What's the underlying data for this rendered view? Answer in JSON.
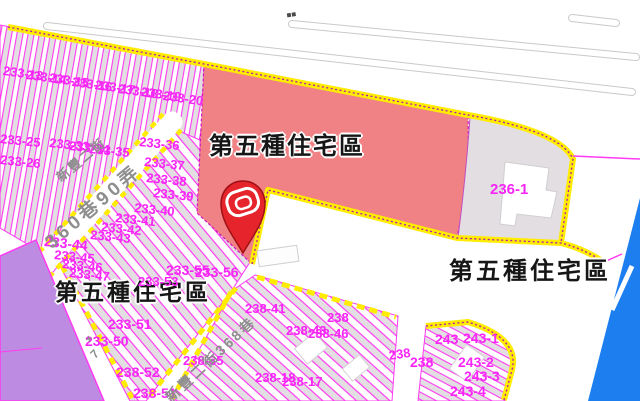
{
  "map": {
    "colors": {
      "red_zone": "#f08184",
      "road_yellow": "#ffec00",
      "boundary_magenta": "#ff3af2",
      "boundary_dark": "#b517ae",
      "parcel_text_magenta": "#f726f7",
      "purple_zone": "#bd8ce2",
      "blue_zone": "#1d7ef0",
      "parcel_gray": "#e2dee2",
      "pin_red": "#e6242b",
      "pin_dark": "#9e1116",
      "road_casing_gray": "#c9c9c9",
      "road_text_gray": "#8e8e8e",
      "zone_label_ink": "#161616"
    },
    "zone_labels": [
      {
        "text": "第五種住宅區",
        "x": 209,
        "y": 135,
        "size": 24,
        "ls": 2
      },
      {
        "text": "第五種住宅區",
        "x": 55,
        "y": 281,
        "size": 23,
        "ls": 3
      },
      {
        "text": "第五種住宅區",
        "x": 449,
        "y": 260,
        "size": 24,
        "ls": 3
      }
    ],
    "parcel_labels": [
      {
        "text": "233-13",
        "x": 4,
        "y": 64,
        "rot": 8
      },
      {
        "text": "233-14",
        "x": 27,
        "y": 68,
        "rot": 8
      },
      {
        "text": "233-15",
        "x": 50,
        "y": 71,
        "rot": 8
      },
      {
        "text": "233-16",
        "x": 73,
        "y": 75,
        "rot": 8
      },
      {
        "text": "233-17",
        "x": 96,
        "y": 78,
        "rot": 8
      },
      {
        "text": "233-18",
        "x": 119,
        "y": 82,
        "rot": 8
      },
      {
        "text": "233-19",
        "x": 142,
        "y": 85,
        "rot": 8
      },
      {
        "text": "233-20",
        "x": 164,
        "y": 89,
        "rot": 8
      },
      {
        "text": "233-25",
        "x": 1,
        "y": 132,
        "rot": 6
      },
      {
        "text": "233-33",
        "x": 50,
        "y": 136,
        "rot": 6
      },
      {
        "text": "233-34",
        "x": 70,
        "y": 139,
        "rot": 6
      },
      {
        "text": "233-35",
        "x": 90,
        "y": 142,
        "rot": 6
      },
      {
        "text": "233-36",
        "x": 140,
        "y": 135,
        "rot": 6
      },
      {
        "text": "233-26",
        "x": 1,
        "y": 153,
        "rot": 6
      },
      {
        "text": "233-37",
        "x": 145,
        "y": 155,
        "rot": 6
      },
      {
        "text": "233-38",
        "x": 147,
        "y": 171,
        "rot": 6
      },
      {
        "text": "233-39",
        "x": 154,
        "y": 186,
        "rot": 6
      },
      {
        "text": "233-40",
        "x": 135,
        "y": 201,
        "rot": 6
      },
      {
        "text": "233-41",
        "x": 116,
        "y": 211,
        "rot": 6
      },
      {
        "text": "233-42",
        "x": 102,
        "y": 220,
        "rot": 6
      },
      {
        "text": "233-43",
        "x": 91,
        "y": 228,
        "rot": 6
      },
      {
        "text": "233-44",
        "x": 45,
        "y": 234,
        "size": 14,
        "rot": 6
      },
      {
        "text": "233-45",
        "x": 55,
        "y": 248,
        "rot": 6
      },
      {
        "text": "233-46",
        "x": 63,
        "y": 257,
        "rot": 6
      },
      {
        "text": "233-47",
        "x": 70,
        "y": 266,
        "rot": 6
      },
      {
        "text": "233-53",
        "x": 138,
        "y": 275
      },
      {
        "text": "233-55",
        "x": 166,
        "y": 263,
        "size": 14
      },
      {
        "text": "233-56",
        "x": 195,
        "y": 265,
        "size": 14
      },
      {
        "text": "233-51",
        "x": 108,
        "y": 317,
        "size": 14
      },
      {
        "text": "233-50",
        "x": 85,
        "y": 334,
        "size": 14
      },
      {
        "text": "238-41",
        "x": 245,
        "y": 302
      },
      {
        "text": "238-43",
        "x": 286,
        "y": 324
      },
      {
        "text": "238-46",
        "x": 308,
        "y": 327
      },
      {
        "text": "238-35",
        "x": 183,
        "y": 354
      },
      {
        "text": "238-52",
        "x": 116,
        "y": 365,
        "size": 14
      },
      {
        "text": "238-51",
        "x": 133,
        "y": 386,
        "size": 14
      },
      {
        "text": "238-18",
        "x": 255,
        "y": 371
      },
      {
        "text": "238-17",
        "x": 282,
        "y": 375
      },
      {
        "text": "238",
        "x": 327,
        "y": 311
      },
      {
        "text": "238",
        "x": 388,
        "y": 349,
        "rot": -8
      },
      {
        "text": "238",
        "x": 410,
        "y": 355,
        "size": 14
      },
      {
        "text": "243",
        "x": 435,
        "y": 332,
        "size": 14
      },
      {
        "text": "243-1",
        "x": 463,
        "y": 331,
        "size": 14
      },
      {
        "text": "243-2",
        "x": 458,
        "y": 355,
        "size": 14
      },
      {
        "text": "243-3",
        "x": 464,
        "y": 369,
        "size": 14
      },
      {
        "text": "243-4",
        "x": 450,
        "y": 384,
        "size": 14
      },
      {
        "text": "236-1",
        "x": 490,
        "y": 182,
        "size": 15
      }
    ],
    "road_labels": [
      {
        "text": "新豐二街",
        "x": 54,
        "y": 174,
        "rot": -40,
        "size": 13,
        "ls": 2
      },
      {
        "text": "360巷90弄",
        "x": 42,
        "y": 238,
        "rot": -40,
        "size": 19,
        "ls": 4
      },
      {
        "text": "新豐二街368巷",
        "x": 163,
        "y": 394,
        "rot": -43,
        "size": 14,
        "ls": 3
      },
      {
        "text": "+",
        "x": 84,
        "y": 334,
        "rot": -15,
        "size": 12
      },
      {
        "text": "7",
        "x": 88,
        "y": 352,
        "rot": -45,
        "size": 12
      },
      {
        "text": "■■",
        "x": 286,
        "y": 12,
        "rot": -9,
        "size": 8,
        "color": "#4a4a4a"
      }
    ]
  }
}
